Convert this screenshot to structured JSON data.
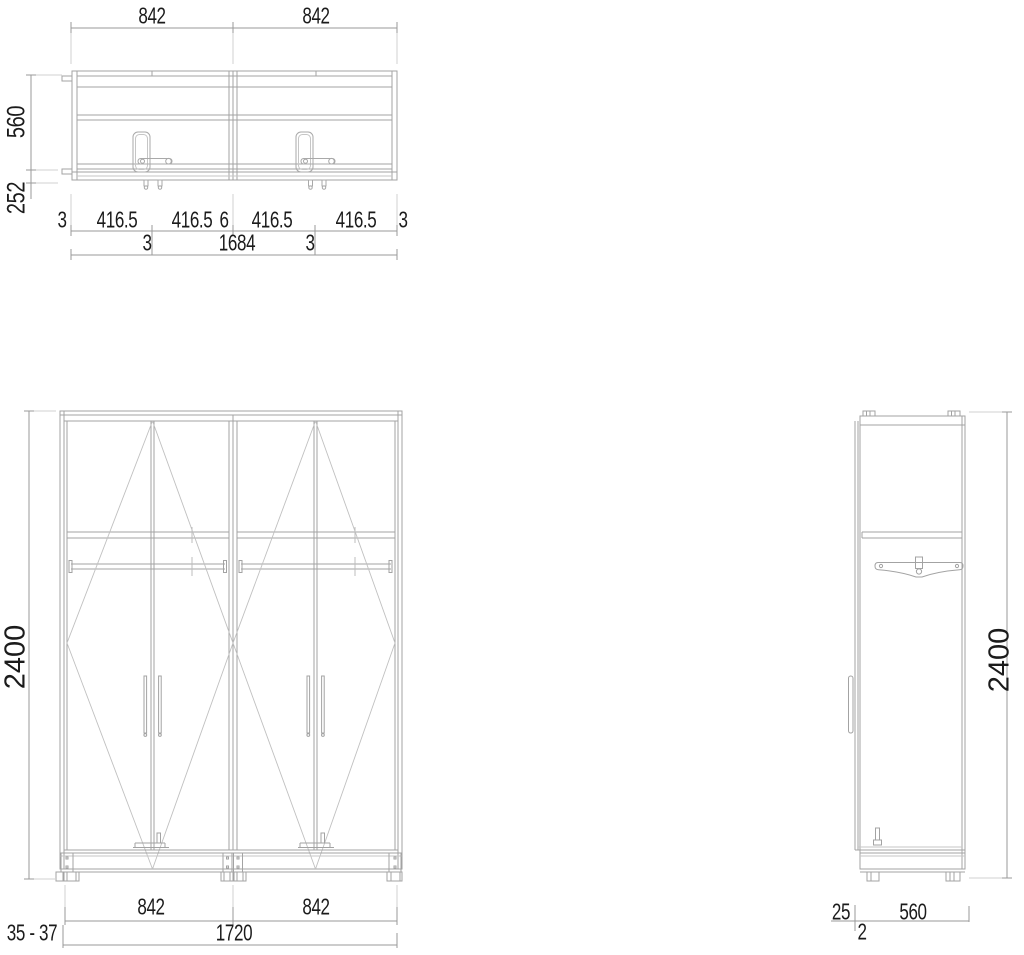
{
  "drawing_title": "wardrobe-three-view-technical-drawing",
  "views": {
    "top": {
      "width_left": "842",
      "width_right": "842",
      "depth": "560",
      "door_clearance": "252",
      "row1": [
        "3",
        "416.5",
        "416.5",
        "6",
        "416.5",
        "416.5",
        "3"
      ],
      "row2_gap_left": "3",
      "row2_gap_right": "3",
      "total_width": "1684"
    },
    "front": {
      "height": "2400",
      "door_width_left": "842",
      "door_width_right": "842",
      "foot_height": "35 - 37",
      "total_width": "1720"
    },
    "side": {
      "height": "2400",
      "door_thickness": "25",
      "gap": "2",
      "depth": "560"
    }
  },
  "colors": {
    "line_main": "#a3a3a3",
    "line_light": "#c6c6c6",
    "dim_line": "#9a9a9a",
    "text": "#1b1b1b",
    "background": "#ffffff"
  }
}
